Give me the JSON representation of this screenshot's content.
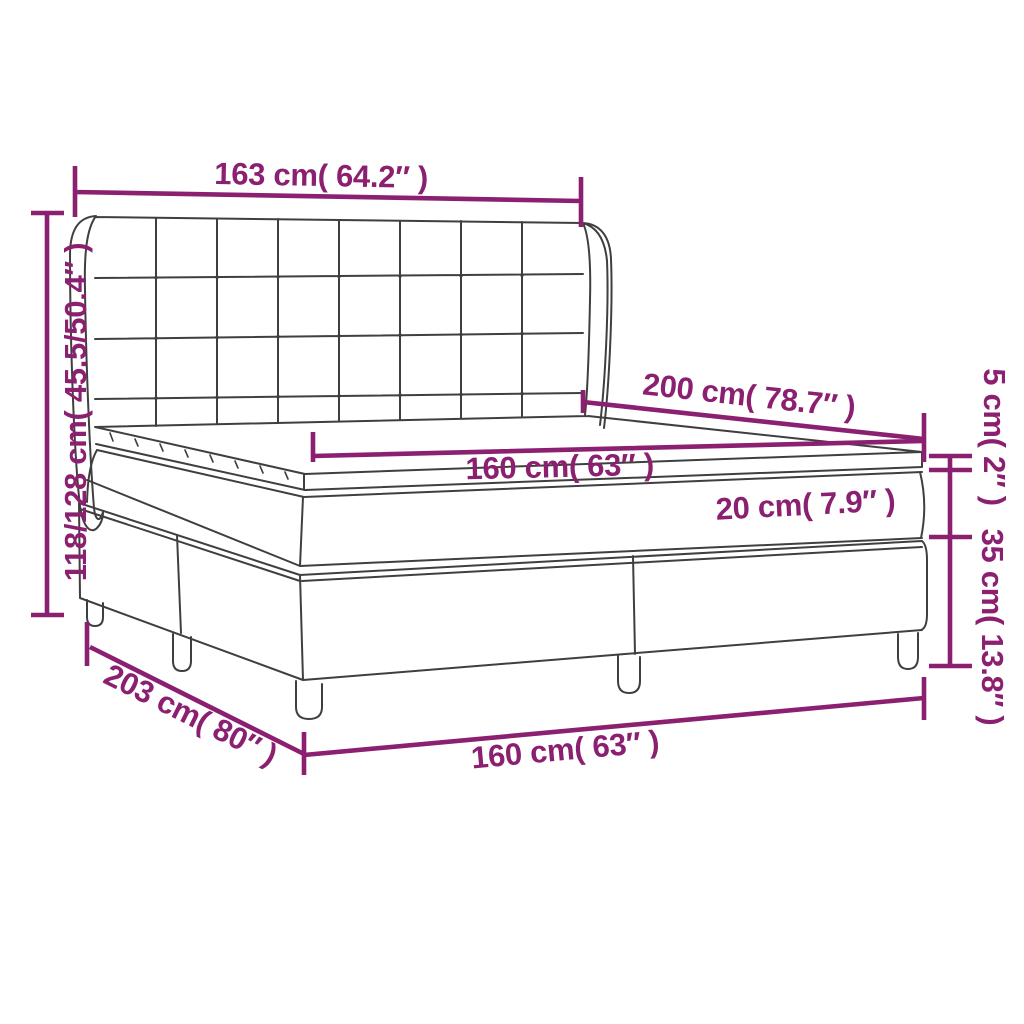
{
  "diagram": {
    "subject": "box-spring-bed-with-tufted-wing-headboard",
    "colors": {
      "dimension_accent": "#8B2071",
      "line_art": "#3f3f3f",
      "background": "#ffffff"
    },
    "labels": {
      "headboard_width": "163 cm( 64.2″ )",
      "total_height": "118/128 cm( 45.5/50.4″ )",
      "bed_length": "200 cm( 78.7″ )",
      "mattress_width": "160 cm( 63″ )",
      "mattress_thickness": "20 cm( 7.9″ )",
      "topper_thickness": "5 cm( 2″ )",
      "base_height": "35 cm( 13.8″ )",
      "base_length": "203 cm( 80″ )",
      "base_width": "160 cm( 63″ )"
    }
  }
}
